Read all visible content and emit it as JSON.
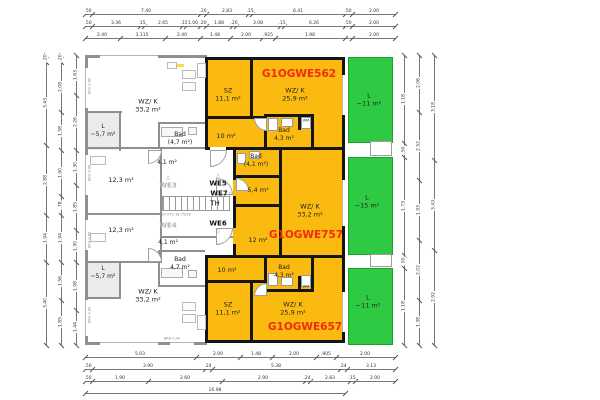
{
  "title": "Obergeschoss Grundriss",
  "colors": {
    "orange": "#fbba10",
    "green": "#2fca43",
    "red": "#f02b0c",
    "wall_black": "#151515",
    "wall_gray": "#8f8f8f"
  },
  "units": {
    "top_code": "G1OGWE562",
    "middle_code": "G1OGWE757",
    "bottom_code": "G1OGWE657"
  },
  "labels": [
    {
      "id": "room-wzk-top-left",
      "lines": [
        "WZ/ K",
        "33,2 m²"
      ],
      "x": 148,
      "y": 106,
      "cls": "room"
    },
    {
      "id": "room-loggia-top-left",
      "lines": [
        "L",
        "~5,7 m²"
      ],
      "x": 103,
      "y": 131,
      "cls": "small"
    },
    {
      "id": "room-bad-top-left",
      "lines": [
        "Bad",
        "(4,7 m²)"
      ],
      "x": 180,
      "y": 139,
      "cls": "small"
    },
    {
      "id": "room-flur-top-left",
      "lines": [
        "4,1 m²"
      ],
      "x": 167,
      "y": 163,
      "cls": "small"
    },
    {
      "id": "room-123-upper",
      "lines": [
        "12,3 m²"
      ],
      "x": 121,
      "y": 180,
      "cls": "room"
    },
    {
      "id": "room-123-lower",
      "lines": [
        "12,3 m²"
      ],
      "x": 121,
      "y": 230,
      "cls": "room"
    },
    {
      "id": "room-flur-bottom-left",
      "lines": [
        "4,1 m²"
      ],
      "x": 168,
      "y": 243,
      "cls": "small"
    },
    {
      "id": "room-bad-bottom-left",
      "lines": [
        "Bad",
        "4,7 m²"
      ],
      "x": 180,
      "y": 264,
      "cls": "small"
    },
    {
      "id": "room-loggia-bottom-left",
      "lines": [
        "L",
        "~5,7 m²"
      ],
      "x": 103,
      "y": 273,
      "cls": "small"
    },
    {
      "id": "room-wzk-bottom-left",
      "lines": [
        "WZ/ K",
        "33,2 m²"
      ],
      "x": 148,
      "y": 296,
      "cls": "room"
    },
    {
      "id": "label-we3",
      "lines": [
        "WE3"
      ],
      "x": 168,
      "y": 186,
      "cls": "core gray"
    },
    {
      "id": "tri-we3-icon",
      "lines": [
        "△"
      ],
      "x": 168,
      "y": 178,
      "cls": "tri"
    },
    {
      "id": "label-we4",
      "lines": [
        "WE4"
      ],
      "x": 168,
      "y": 226,
      "cls": "core gray"
    },
    {
      "id": "stair-note",
      "lines": [
        "16 STG 18.75/28"
      ],
      "x": 176,
      "y": 215,
      "cls": "tinygray"
    },
    {
      "id": "label-we5",
      "lines": [
        "WE5"
      ],
      "x": 218,
      "y": 184,
      "cls": "core"
    },
    {
      "id": "tri-we5-icon",
      "lines": [
        "△"
      ],
      "x": 218,
      "y": 176,
      "cls": "tri"
    },
    {
      "id": "label-we7",
      "lines": [
        "WE7"
      ],
      "x": 219,
      "y": 194,
      "cls": "core"
    },
    {
      "id": "tri-we7-icon",
      "lines": [
        "▷"
      ],
      "x": 231,
      "y": 194,
      "cls": "tri"
    },
    {
      "id": "label-th",
      "lines": [
        "TH"
      ],
      "x": 215,
      "y": 204,
      "cls": "core plain"
    },
    {
      "id": "label-we6",
      "lines": [
        "WE6"
      ],
      "x": 218,
      "y": 224,
      "cls": "core"
    },
    {
      "id": "tri-we6-icon",
      "lines": [
        "▽"
      ],
      "x": 218,
      "y": 232,
      "cls": "tri"
    },
    {
      "id": "room-sz-top",
      "lines": [
        "SZ",
        "11,1 m²"
      ],
      "x": 228,
      "y": 95,
      "cls": "room"
    },
    {
      "id": "room-wzk-562",
      "lines": [
        "WZ/ K",
        "25,9 m²"
      ],
      "x": 295,
      "y": 95,
      "cls": "room"
    },
    {
      "id": "unit-code-562",
      "lines": [
        "G1OGWE562"
      ],
      "x": 299,
      "y": 75,
      "cls": "code"
    },
    {
      "id": "room-bad-562",
      "lines": [
        "Bad",
        "4,3 m²"
      ],
      "x": 284,
      "y": 135,
      "cls": "small"
    },
    {
      "id": "label-wm-top",
      "lines": [
        "WM"
      ],
      "x": 306,
      "y": 121,
      "cls": "tinydark"
    },
    {
      "id": "room-flur-562",
      "lines": [
        "10 m²"
      ],
      "x": 226,
      "y": 136,
      "cls": "room"
    },
    {
      "id": "room-bad-757",
      "lines": [
        "Bad",
        "(4,1 m²)"
      ],
      "x": 256,
      "y": 161,
      "cls": "small"
    },
    {
      "id": "room-hall-757",
      "lines": [
        "5,4 m²"
      ],
      "x": 258,
      "y": 190,
      "cls": "room"
    },
    {
      "id": "room-wzk-757",
      "lines": [
        "WZ/ K",
        "33,2 m²"
      ],
      "x": 310,
      "y": 211,
      "cls": "room"
    },
    {
      "id": "unit-code-757",
      "lines": [
        "G1OGWE757"
      ],
      "x": 306,
      "y": 236,
      "cls": "code"
    },
    {
      "id": "room-sz-757",
      "lines": [
        "12 m²"
      ],
      "x": 258,
      "y": 240,
      "cls": "room"
    },
    {
      "id": "room-flur-657",
      "lines": [
        "10 m²"
      ],
      "x": 227,
      "y": 270,
      "cls": "room"
    },
    {
      "id": "room-bad-657",
      "lines": [
        "Bad",
        "4,3 m²"
      ],
      "x": 284,
      "y": 272,
      "cls": "small"
    },
    {
      "id": "label-wm-bottom",
      "lines": [
        "WM"
      ],
      "x": 306,
      "y": 287,
      "cls": "tinydark"
    },
    {
      "id": "room-sz-bottom",
      "lines": [
        "SZ",
        "11,1 m²"
      ],
      "x": 228,
      "y": 309,
      "cls": "room"
    },
    {
      "id": "room-wzk-657",
      "lines": [
        "WZ/ K",
        "25,9 m²"
      ],
      "x": 293,
      "y": 309,
      "cls": "room"
    },
    {
      "id": "unit-code-657",
      "lines": [
        "G1OGWE657"
      ],
      "x": 305,
      "y": 328,
      "cls": "code"
    },
    {
      "id": "balcony-label-top",
      "lines": [
        "L",
        "~11 m²"
      ],
      "x": 369,
      "y": 100,
      "cls": "room"
    },
    {
      "id": "balcony-label-mid",
      "lines": [
        "L",
        "~15 m²"
      ],
      "x": 367,
      "y": 202,
      "cls": "room"
    },
    {
      "id": "balcony-label-bottom",
      "lines": [
        "L",
        "~11 m²"
      ],
      "x": 368,
      "y": 302,
      "cls": "room"
    },
    {
      "id": "window-note-1",
      "lines": [
        "BRH 0.90"
      ],
      "x": 90,
      "y": 86,
      "cls": "brh"
    },
    {
      "id": "window-note-2",
      "lines": [
        "BRH 0.90"
      ],
      "x": 90,
      "y": 173,
      "cls": "brh"
    },
    {
      "id": "window-note-3",
      "lines": [
        "BRH 0.90"
      ],
      "x": 90,
      "y": 240,
      "cls": "brh"
    },
    {
      "id": "window-note-4",
      "lines": [
        "BRH 0.90"
      ],
      "x": 90,
      "y": 315,
      "cls": "brh"
    },
    {
      "id": "window-note-5",
      "lines": [
        "BRH 0.40"
      ],
      "x": 172,
      "y": 339,
      "cls": "tinygray"
    }
  ],
  "dimensions": {
    "chains": [
      {
        "o": "h",
        "y": 14,
        "x1": 85,
        "x2": 395,
        "ticks": [
          85,
          92,
          200,
          206,
          248,
          252,
          345,
          352,
          395
        ],
        "labels": [
          {
            "t": ".50",
            "p": 88
          },
          {
            "t": "7.40",
            "p": 146
          },
          {
            "t": ".20",
            "p": 203
          },
          {
            "t": "2.83",
            "p": 227
          },
          {
            "t": ".15",
            "p": 250
          },
          {
            "t": "6.41",
            "p": 298
          },
          {
            "t": ".50",
            "p": 348
          },
          {
            "t": "2.00",
            "p": 374
          }
        ]
      },
      {
        "o": "h",
        "y": 26,
        "x1": 85,
        "x2": 395,
        "ticks": [
          85,
          92,
          140,
          144,
          182,
          186,
          200,
          206,
          232,
          236,
          280,
          284,
          345,
          352,
          395
        ],
        "labels": [
          {
            "t": ".50",
            "p": 88
          },
          {
            "t": "3.36",
            "p": 116
          },
          {
            "t": ".15",
            "p": 142
          },
          {
            "t": "2.65",
            "p": 163
          },
          {
            "t": ".15",
            "p": 184
          },
          {
            "t": "1.00",
            "p": 193
          },
          {
            "t": ".20",
            "p": 203
          },
          {
            "t": "1.88",
            "p": 219
          },
          {
            "t": ".20",
            "p": 234
          },
          {
            "t": "3.08",
            "p": 258
          },
          {
            "t": ".15",
            "p": 282
          },
          {
            "t": "6.26",
            "p": 314
          },
          {
            "t": ".50",
            "p": 348
          },
          {
            "t": "2.00",
            "p": 374
          }
        ]
      },
      {
        "o": "h",
        "y": 38,
        "x1": 85,
        "x2": 395,
        "ticks": [
          85,
          120,
          165,
          200,
          230,
          262,
          275,
          345,
          352,
          395
        ],
        "labels": [
          {
            "t": "2.40",
            "p": 102
          },
          {
            "t": "3.115",
            "p": 142
          },
          {
            "t": "2.40",
            "p": 182
          },
          {
            "t": "1.48",
            "p": 215
          },
          {
            "t": "2.00",
            "p": 246
          },
          {
            "t": ".925",
            "p": 268
          },
          {
            "t": "1.98",
            "p": 310
          },
          {
            "t": "2.00",
            "p": 374
          }
        ]
      },
      {
        "o": "h",
        "y": 357,
        "x1": 85,
        "x2": 395,
        "ticks": [
          85,
          196,
          240,
          272,
          316,
          336,
          395
        ],
        "labels": [
          {
            "t": "5.03",
            "p": 140
          },
          {
            "t": "2.00",
            "p": 218
          },
          {
            "t": "1.48",
            "p": 256
          },
          {
            "t": "2.00",
            "p": 294
          },
          {
            "t": ".905",
            "p": 326
          },
          {
            "t": "2.00",
            "p": 365
          }
        ]
      },
      {
        "o": "h",
        "y": 369,
        "x1": 85,
        "x2": 395,
        "ticks": [
          85,
          92,
          205,
          212,
          340,
          347,
          395
        ],
        "labels": [
          {
            "t": ".50",
            "p": 88
          },
          {
            "t": "3.90",
            "p": 148
          },
          {
            "t": ".24",
            "p": 208
          },
          {
            "t": "5.38",
            "p": 276
          },
          {
            "t": ".24",
            "p": 343
          },
          {
            "t": "3.13",
            "p": 371
          }
        ]
      },
      {
        "o": "h",
        "y": 381,
        "x1": 85,
        "x2": 395,
        "ticks": [
          85,
          92,
          148,
          222,
          305,
          310,
          350,
          355,
          395
        ],
        "labels": [
          {
            "t": ".50",
            "p": 88
          },
          {
            "t": "1.90",
            "p": 120
          },
          {
            "t": "2.60",
            "p": 185
          },
          {
            "t": "2.90",
            "p": 263
          },
          {
            "t": ".24",
            "p": 307
          },
          {
            "t": "2.83",
            "p": 330
          },
          {
            "t": ".15",
            "p": 352
          },
          {
            "t": "2.00",
            "p": 375
          }
        ]
      },
      {
        "o": "h",
        "y": 393,
        "x1": 85,
        "x2": 345,
        "ticks": [
          85,
          345
        ],
        "labels": [
          {
            "t": "16.98",
            "p": 215
          }
        ]
      },
      {
        "o": "v",
        "x": 46,
        "y1": 55,
        "y2": 345,
        "ticks": [
          55,
          62,
          145,
          215,
          262,
          345
        ],
        "labels": [
          {
            "t": ".20",
            "p": 58
          },
          {
            "t": "3.43",
            "p": 103
          },
          {
            "t": "2.88",
            "p": 180
          },
          {
            "t": "1.94",
            "p": 238
          },
          {
            "t": "3.40",
            "p": 303
          }
        ]
      },
      {
        "o": "v",
        "x": 61,
        "y1": 55,
        "y2": 345,
        "ticks": [
          55,
          62,
          112,
          150,
          196,
          215,
          262,
          300,
          345
        ],
        "labels": [
          {
            "t": ".20",
            "p": 58
          },
          {
            "t": "2.08",
            "p": 87
          },
          {
            "t": "1.58",
            "p": 131
          },
          {
            "t": "1.90",
            "p": 173
          },
          {
            "t": ".78",
            "p": 205
          },
          {
            "t": "1.94",
            "p": 238
          },
          {
            "t": "1.56",
            "p": 281
          },
          {
            "t": "1.85",
            "p": 322
          }
        ]
      },
      {
        "o": "v",
        "x": 76,
        "y1": 55,
        "y2": 345,
        "ticks": [
          55,
          95,
          150,
          185,
          230,
          262,
          310,
          345
        ],
        "labels": [
          {
            "t": "1.63",
            "p": 75
          },
          {
            "t": "2.26",
            "p": 122
          },
          {
            "t": "1.30",
            "p": 167
          },
          {
            "t": "1.85",
            "p": 207
          },
          {
            "t": "1.30",
            "p": 246
          },
          {
            "t": "1.98",
            "p": 286
          },
          {
            "t": "1.44",
            "p": 327
          }
        ]
      },
      {
        "o": "v",
        "x": 404,
        "y1": 55,
        "y2": 345,
        "ticks": [
          55,
          143,
          157,
          255,
          268,
          345
        ],
        "labels": [
          {
            "t": "1.18",
            "p": 99
          },
          {
            "t": ".50",
            "p": 150
          },
          {
            "t": "1.73",
            "p": 206
          },
          {
            "t": ".50",
            "p": 261
          },
          {
            "t": "1.18",
            "p": 306
          }
        ]
      },
      {
        "o": "v",
        "x": 419,
        "y1": 55,
        "y2": 345,
        "ticks": [
          55,
          112,
          180,
          240,
          300,
          345
        ],
        "labels": [
          {
            "t": "2.06",
            "p": 83
          },
          {
            "t": "2.52",
            "p": 146
          },
          {
            "t": "1.93",
            "p": 210
          },
          {
            "t": "2.02",
            "p": 270
          },
          {
            "t": "1.38",
            "p": 322
          }
        ]
      },
      {
        "o": "v",
        "x": 434,
        "y1": 55,
        "y2": 345,
        "ticks": [
          55,
          160,
          250,
          345
        ],
        "labels": [
          {
            "t": "3.18",
            "p": 107
          },
          {
            "t": "3.43",
            "p": 205
          },
          {
            "t": "2.92",
            "p": 297
          }
        ]
      }
    ]
  }
}
